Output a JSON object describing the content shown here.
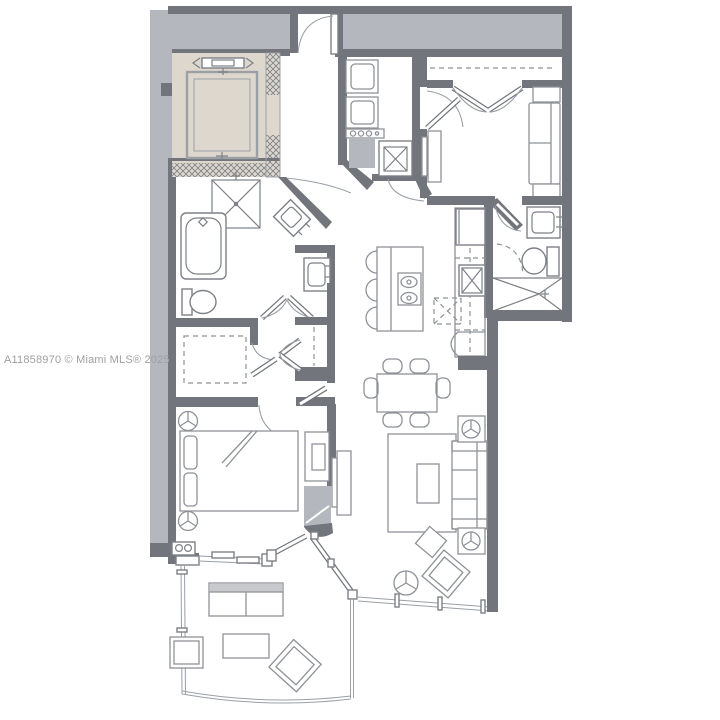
{
  "watermark": {
    "text": "A11858970 © Miami MLS® 2025"
  },
  "palette": {
    "background": "#ffffff",
    "wall": "#72767c",
    "wall-light": "#9aa0a6",
    "shade": "#b4b8be",
    "elevator-fill": "#ddd7ce",
    "hatch-line": "#7d8187",
    "fixture-line": "#7d8187",
    "furniture-line": "#8e9298",
    "soft-fill": "#c7c9cc",
    "watermark-color": "#9fa0a3"
  },
  "plan": {
    "type": "residential-condo-floor-plan",
    "rooms": [
      "private-elevator",
      "entry-foyer",
      "laundry-utility-closet",
      "den-second-bedroom",
      "bathroom-2",
      "kitchen",
      "dining-area",
      "living-room",
      "master-bathroom",
      "walk-in-closet",
      "linen-closet",
      "master-bedroom",
      "balcony-terrace"
    ],
    "fixtures": [
      "elevator-cab",
      "entry-door",
      "washer",
      "dryer",
      "water-heater",
      "air-handler",
      "den-closet-double-doors",
      "den-daybed-sofa",
      "tv-console",
      "vanity-sink",
      "toilet",
      "walk-in-shower",
      "refrigerator",
      "kitchen-sink",
      "dishwasher",
      "kitchen-island",
      "cooktop",
      "bar-stools",
      "bathtub",
      "corner-shower",
      "bed",
      "nightstands",
      "structural-column",
      "balcony-swing-door",
      "sliding-glass-door",
      "dining-table",
      "dining-chairs",
      "sofa",
      "side-tables",
      "area-rug",
      "coffee-table",
      "bistro-table",
      "lounge-chairs",
      "outdoor-sofa",
      "outdoor-coffee-table",
      "outdoor-chair",
      "balcony-railing",
      "window-wall"
    ]
  }
}
